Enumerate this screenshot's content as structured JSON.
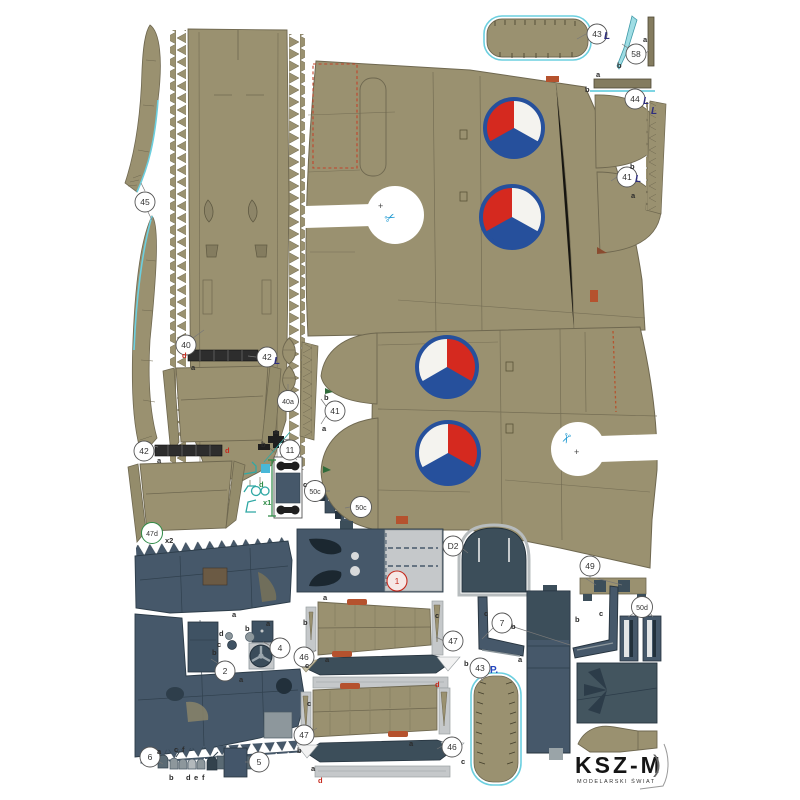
{
  "sheet": {
    "kind": "paper-model-parts-sheet",
    "aircraft_markings": "czechoslovak-roundels",
    "logo": {
      "title": "KSZ-M",
      "subtitle": "MODELARSKI ŚWIAT",
      "bracket": ")"
    }
  },
  "colors": {
    "khaki": "#9a9170",
    "khaki_dark": "#847c5f",
    "slate": "#46586a",
    "slate_dark": "#3c4e5a",
    "light_gray": "#c5c8ca",
    "roundel_blue": "#26509c",
    "roundel_red": "#d5291f",
    "cyan_edge": "#6ccfdf",
    "navy_L": "#2e2e7e",
    "red_label": "#c62a1e",
    "green_mark": "#2e8b46",
    "teal_tool": "#2fa8a4",
    "blue_P": "#2447c0"
  },
  "badges": {
    "p45": "45",
    "p40": "40",
    "p42a": "42",
    "p40a": "40a",
    "p41m": "41",
    "p42b": "42",
    "p47d": "47d",
    "p11": "11",
    "p50c1": "50c",
    "p50c2": "50c",
    "p43t": "43",
    "p58": "58",
    "p44": "44",
    "p41t": "41",
    "p1": "1",
    "pD2": "D2",
    "p2": "2",
    "p4": "4",
    "p5": "5",
    "p6": "6",
    "p7": "7",
    "p49": "49",
    "p50d": "50d",
    "p43p": "43",
    "p46u": "46",
    "p47u": "47",
    "p47l": "47",
    "p46l": "46"
  },
  "letters": {
    "l58a": "a",
    "l58b": "b",
    "l44a": "a",
    "l44b": "b",
    "l41tb": "b",
    "l41ta": "a",
    "l41mb": "b",
    "l41ma": "a",
    "l42ad": "d",
    "l42aa": "a",
    "l42bd": "d",
    "l42ba": "a",
    "l11a": "a",
    "l11b": "b",
    "l11c": "c",
    "ltool_d": "d",
    "lx1": "x1",
    "lx2": "x2",
    "l2a1": "a",
    "l2b": "b",
    "l2a2": "a",
    "l4d": "d",
    "l4c": "c",
    "l4b": "b",
    "l4a": "a",
    "l6a": "a",
    "l6c": "c",
    "l6f1": "f",
    "l6b": "b",
    "l6d": "d",
    "l6e": "e",
    "l6f2": "f",
    "l7c1": "c",
    "l7b1": "b",
    "l7b2": "b",
    "l7c2": "c",
    "l7a": "a",
    "l47ua": "a",
    "l47ub": "b",
    "l47uc": "c",
    "l46uc": "c",
    "l46ua": "a",
    "l46ub": "b",
    "l46ud": "d",
    "l47lc": "c",
    "l47lb": "b",
    "l47la": "a",
    "l46la": "a",
    "l46lc": "c",
    "l46ld": "d",
    "lP": "P."
  },
  "marks": {
    "L": "L",
    "scissors": "✂",
    "plus": "+"
  }
}
